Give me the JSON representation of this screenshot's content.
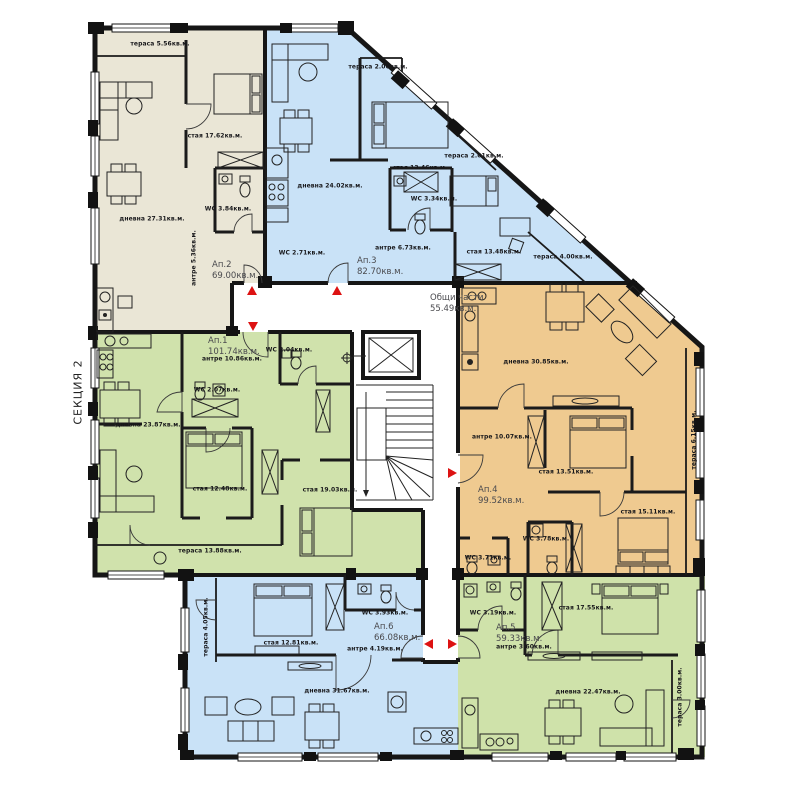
{
  "section_label": "СЕКЦИЯ 2",
  "common_area": {
    "name": "Общи части",
    "area": "55.49кв.м."
  },
  "colors": {
    "wall": "#161616",
    "ap1_green": "#d0e2ac",
    "ap2_beige": "#eae6d6",
    "ap3_blue": "#c9e2f7",
    "ap4_orange": "#efca90",
    "ap5_green": "#cfe2aa",
    "ap6_blue": "#c9e2f7",
    "arrow_red": "#dd1212"
  },
  "apartments": [
    {
      "id": "Ап.1",
      "area": "101.74кв.м.",
      "rooms": [
        "антре 10.86кв.м.",
        "WC 2.04кв.м.",
        "WC 2.07кв.м.",
        "дневна 23.87кв.м.",
        "стая 12.48кв.м.",
        "стая 19.03кв.м.",
        "тераса 13.88кв.м."
      ]
    },
    {
      "id": "Ап.2",
      "area": "69.00кв.м.",
      "rooms": [
        "тераса 5.56кв.м.",
        "стая 17.62кв.м.",
        "дневна 27.31кв.м.",
        "WC 3.84кв.м.",
        "антре 5.36кв.м."
      ]
    },
    {
      "id": "Ап.3",
      "area": "82.70кв.м.",
      "rooms": [
        "тераса 2.06кв.м.",
        "дневна 24.02кв.м.",
        "стая 13.46кв.м.",
        "тераса 2.01кв.м.",
        "WC 3.34кв.м.",
        "антре 6.73кв.м.",
        "WC 2.71кв.м.",
        "стая 13.48кв.м.",
        "тераса 4.00кв.м."
      ]
    },
    {
      "id": "Ап.4",
      "area": "99.52кв.м.",
      "rooms": [
        "дневна 30.85кв.м.",
        "антре 10.07кв.м.",
        "стая 13.51кв.м.",
        "стая 15.11кв.м.",
        "WC 3.78кв.м.",
        "WC 3.71кв.м.",
        "тераса 6.15кв.м."
      ]
    },
    {
      "id": "Ап.5",
      "area": "59.33кв.м.",
      "rooms": [
        "WC 3.19кв.м.",
        "стая 17.55кв.м.",
        "антре 3.60кв.м.",
        "дневна 22.47кв.м.",
        "тераса 3.00кв.м."
      ]
    },
    {
      "id": "Ап.6",
      "area": "66.08кв.м.",
      "rooms": [
        "тераса 4.05кв.м.",
        "стая 12.81кв.м.",
        "WC 3.93кв.м.",
        "антре 4.19кв.м.",
        "дневна 31.67кв.м."
      ]
    }
  ]
}
